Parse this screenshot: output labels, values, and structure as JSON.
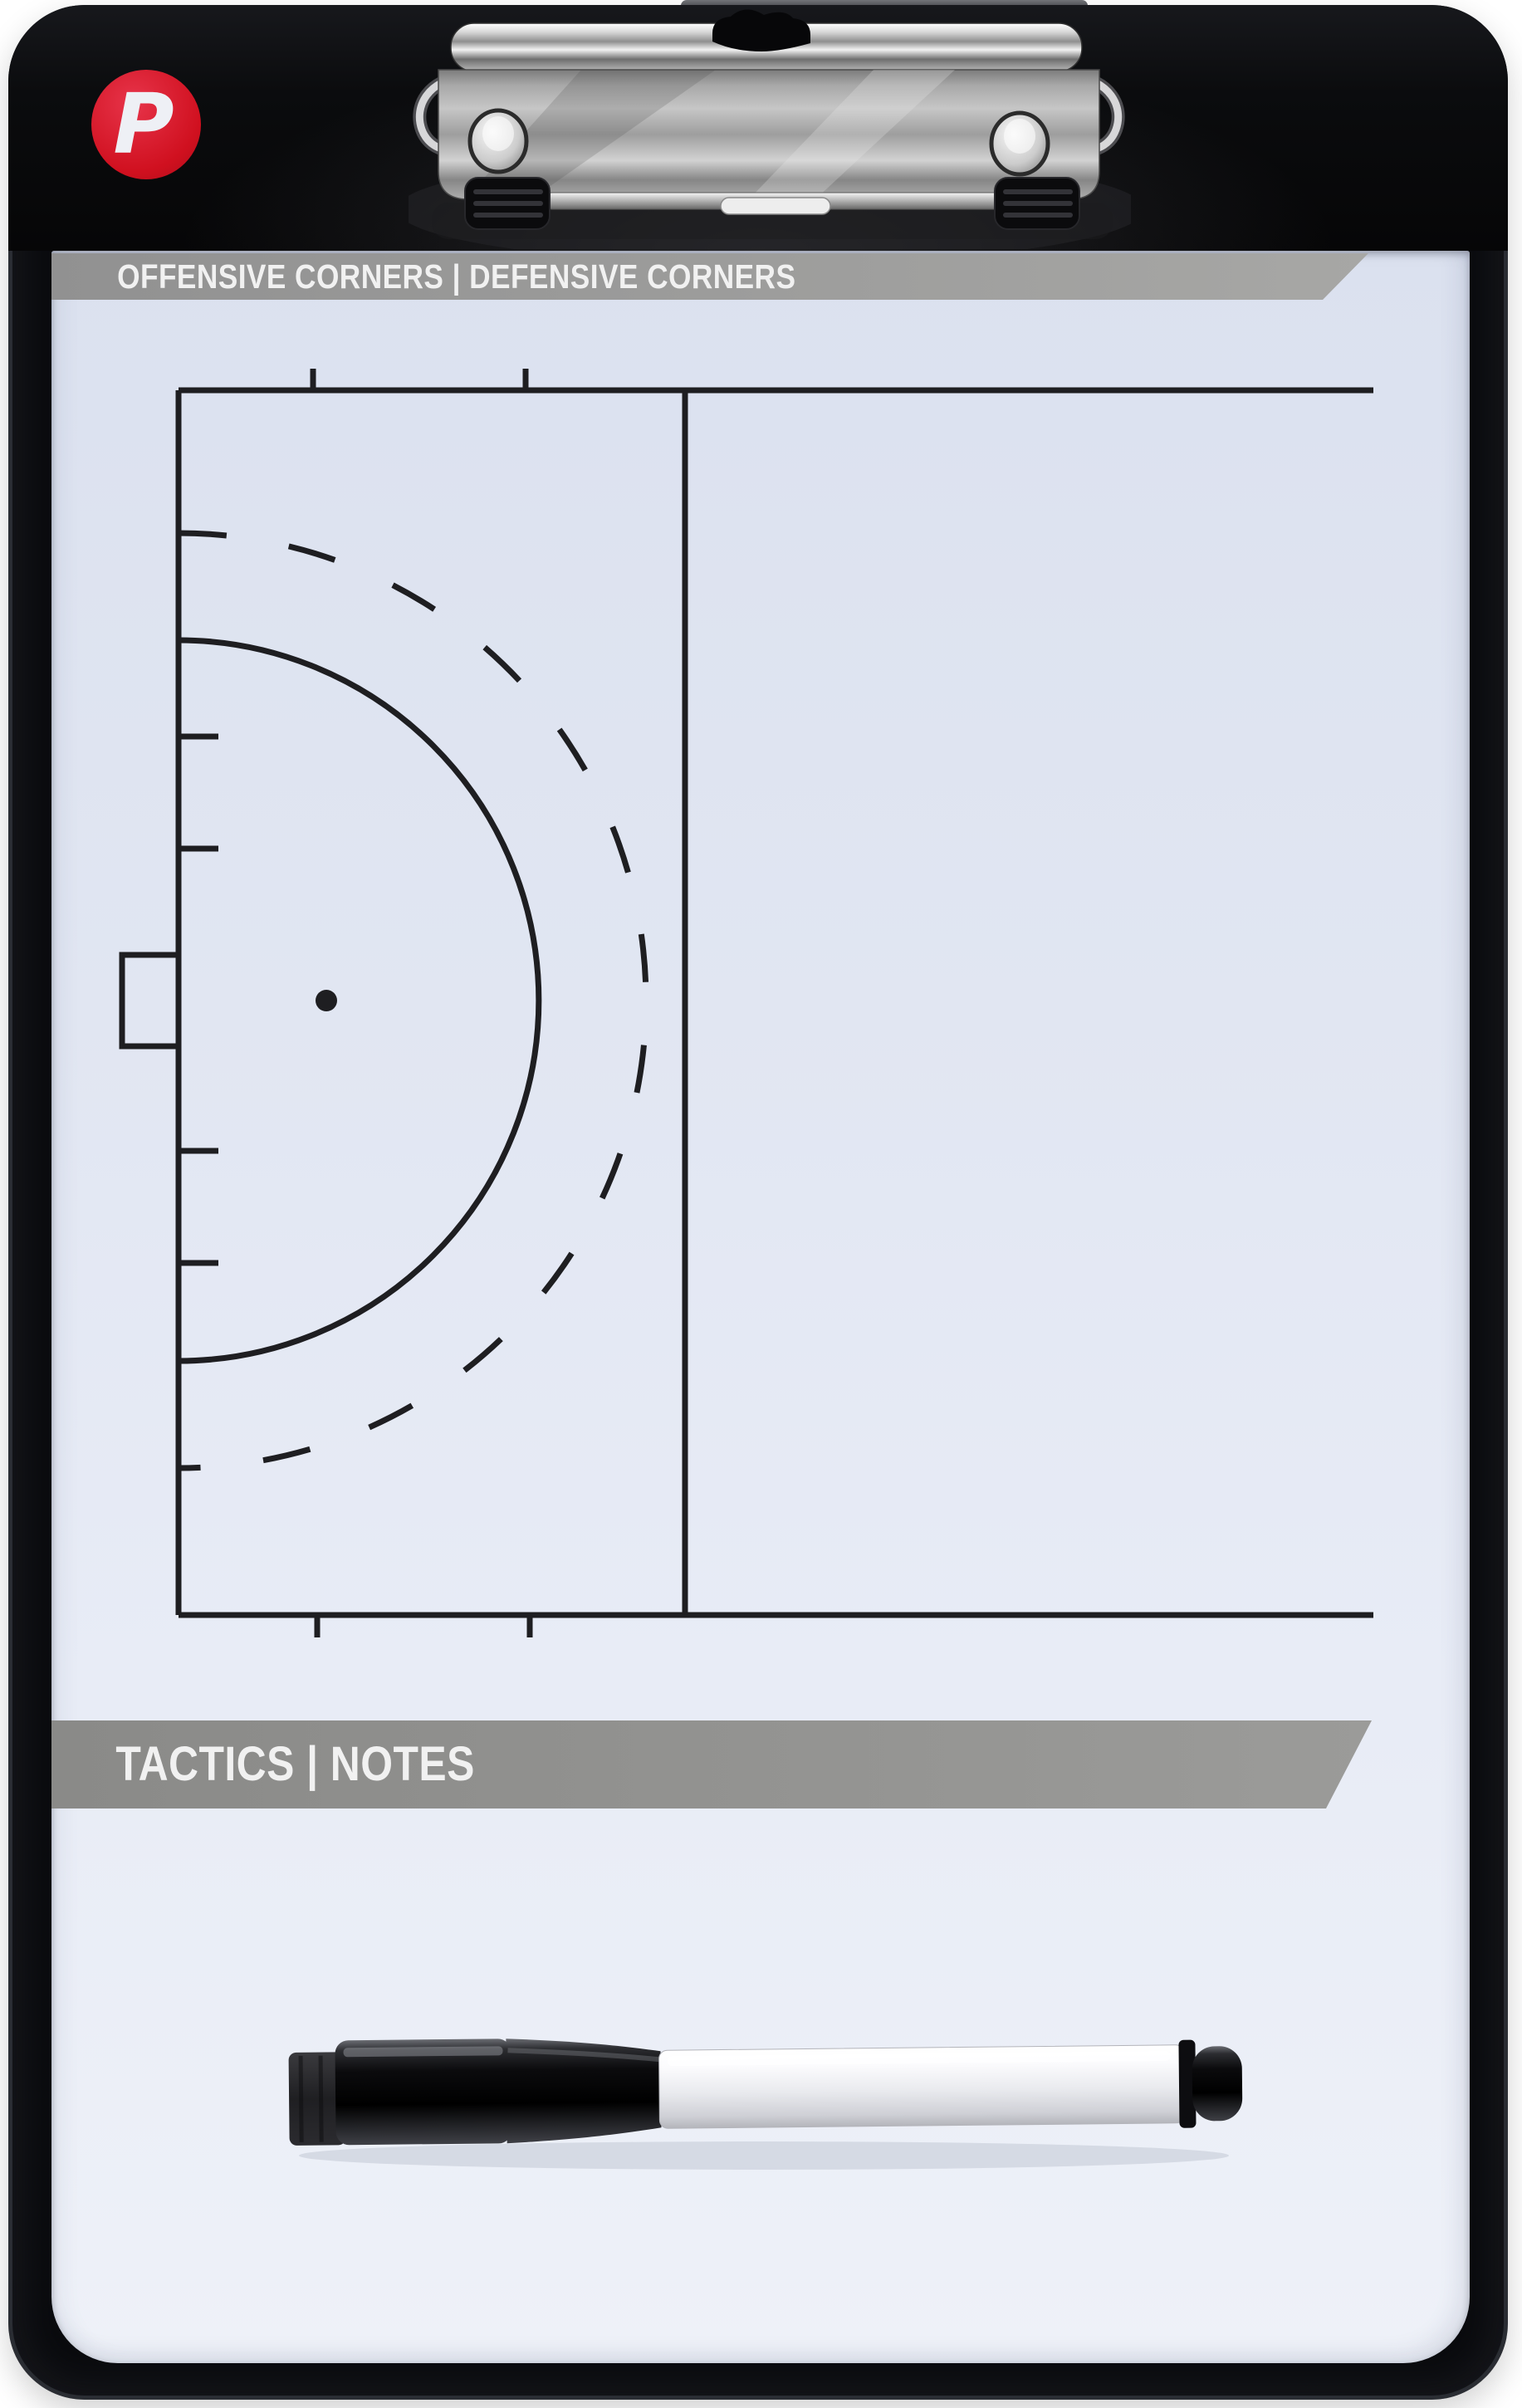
{
  "product": {
    "kind": "coaching-clipboard-photo",
    "logo_letter": "P"
  },
  "banners": {
    "top": "OFFENSIVE CORNERS | DEFENSIVE CORNERS",
    "bottom": "TACTICS | NOTES"
  },
  "colors": {
    "accent_red": "#d0101f",
    "banner_gray": "#979795",
    "frame_black": "#0a0b0e",
    "surface_tint": "#e4e9f4",
    "field_line": "#1e1e21",
    "metal_silver": "#c9c9c9",
    "text_white": "#f1f1f1"
  },
  "icons": [
    {
      "name": "brand-logo-p",
      "glyph": "P"
    },
    {
      "name": "clipboard-clip"
    },
    {
      "name": "marker-pen"
    },
    {
      "name": "eraser-felt-tip"
    }
  ],
  "field_diagram": {
    "sport": "field-hockey-half-pitch",
    "elements": [
      "backline",
      "sideline-top",
      "sideline-bottom",
      "23m-line",
      "goal-box",
      "penalty-spot",
      "shooting-circle-solid",
      "shooting-circle-dashed",
      "backline-hash-marks",
      "corner-hash-marks"
    ]
  }
}
